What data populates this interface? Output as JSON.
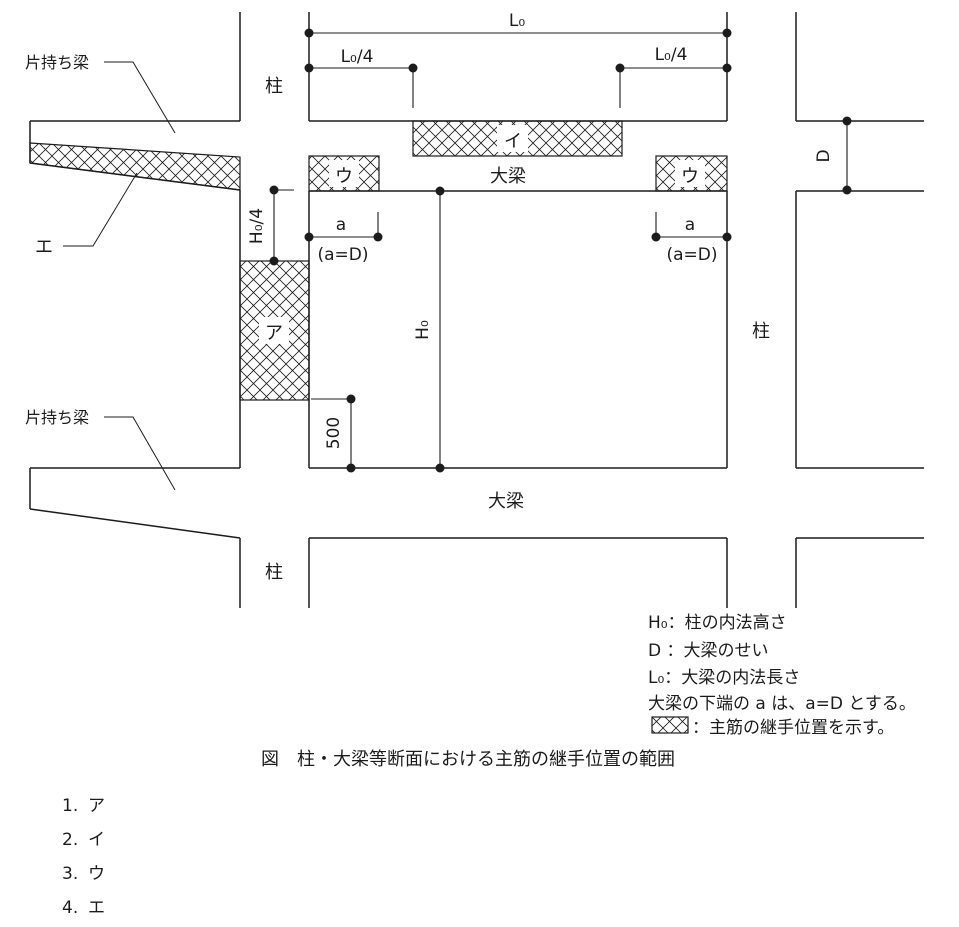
{
  "colors": {
    "line": "#1c1c1c",
    "background": "#ffffff"
  },
  "diagram": {
    "labels": {
      "cantilever_upper": "片持ち梁",
      "cantilever_lower": "片持ち梁",
      "column_upper_left": "柱",
      "column_right": "柱",
      "column_lower_left": "柱",
      "girder_upper": "大梁",
      "girder_lower": "大梁"
    },
    "regions": {
      "a": "ア",
      "i": "イ",
      "u_left": "ウ",
      "u_right": "ウ",
      "e": "エ"
    },
    "dimensions": {
      "l0": "L₀",
      "l0_quarter_left": "L₀/4",
      "l0_quarter_right": "L₀/4",
      "h0": "H₀",
      "h0_quarter": "H₀/4",
      "depth_d": "D",
      "a_left": "a",
      "a_right": "a",
      "a_equals_d_left": "(a=D)",
      "a_equals_d_right": "(a=D)",
      "len_500": "500"
    },
    "legend": {
      "items": [
        {
          "text": "H₀：柱の内法高さ"
        },
        {
          "text": "D ：大梁のせい"
        },
        {
          "text": "L₀：大梁の内法長さ"
        },
        {
          "text": "大梁の下端の a は、a=D とする。"
        },
        {
          "text": "：主筋の継手位置を示す。"
        }
      ]
    },
    "caption": "図　柱・大梁等断面における主筋の継手位置の範囲"
  },
  "choices": [
    {
      "number": "1.",
      "label": "ア"
    },
    {
      "number": "2.",
      "label": "イ"
    },
    {
      "number": "3.",
      "label": "ウ"
    },
    {
      "number": "4.",
      "label": "エ"
    }
  ]
}
